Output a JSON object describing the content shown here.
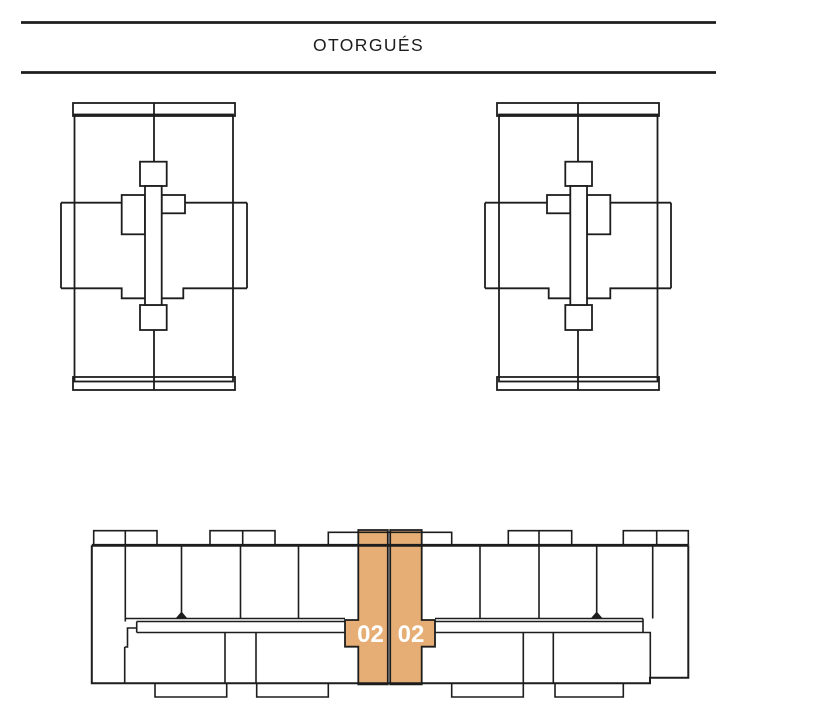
{
  "header": {
    "title": "OTORGUÉS"
  },
  "floor_plan": {
    "selected_units": [
      {
        "label": "02"
      },
      {
        "label": "02"
      }
    ]
  },
  "colors": {
    "line": "#1d1d1d",
    "highlight_fill": "#e6ae74",
    "unit_label": "#ffffff",
    "background": "#ffffff"
  }
}
